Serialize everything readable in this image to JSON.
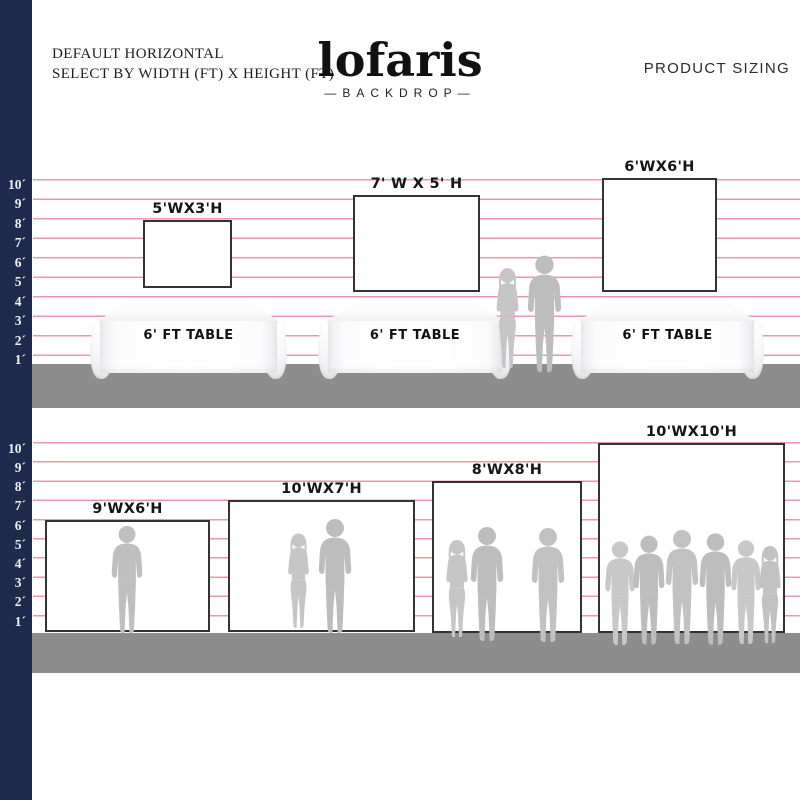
{
  "header": {
    "subtitle_line1": "DEFAULT HORIZONTAL",
    "subtitle_line2": "SELECT BY WIDTH (FT) X HEIGHT (FT)",
    "logo_name": "lofaris",
    "logo_tagline": "—BACKDROP—",
    "product_sizing": "PRODUCT SIZING"
  },
  "scale": {
    "unit": "ft",
    "labels": [
      "10´",
      "9´",
      "8´",
      "7´",
      "6´",
      "5´",
      "4´",
      "3´",
      "2´",
      "1´"
    ]
  },
  "top_row": {
    "backdrops": [
      {
        "label": "5'WX3'H"
      },
      {
        "label": "7' W X 5' H"
      },
      {
        "label": "6'WX6'H"
      }
    ],
    "table_label": "6' FT TABLE"
  },
  "bottom_row": {
    "backdrops": [
      {
        "label": "9'WX6'H"
      },
      {
        "label": "10'WX7'H"
      },
      {
        "label": "8'WX8'H"
      },
      {
        "label": "10'WX10'H"
      }
    ]
  },
  "colors": {
    "navy": "#1e2b4d",
    "pink": "#ee97a4",
    "ground": "#8d8d8d",
    "border": "#333333",
    "sil-a": "#bdbdbd",
    "sil-b": "#c6c6c6"
  }
}
